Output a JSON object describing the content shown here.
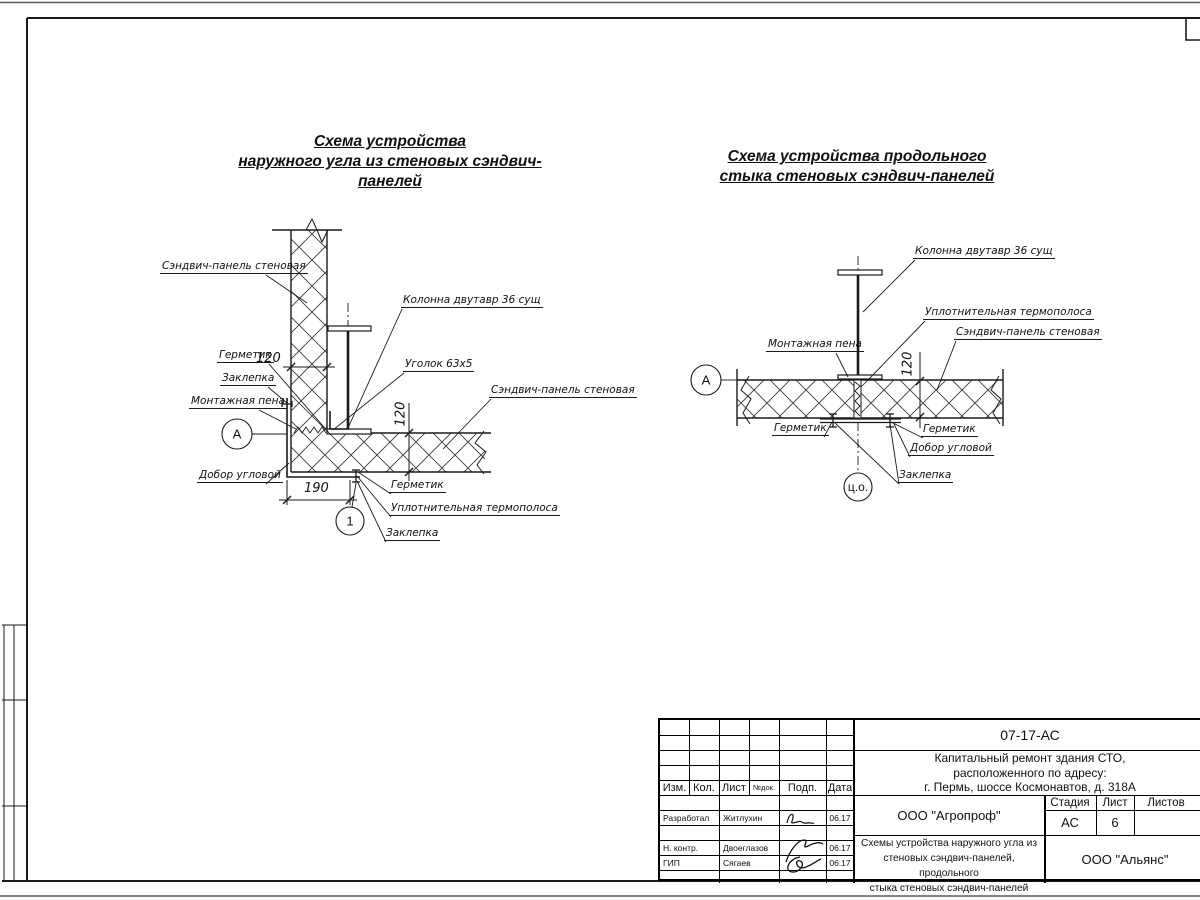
{
  "titles": {
    "left": [
      "Схема устройства",
      "наружного угла из стеновых сэндвич-панелей"
    ],
    "right": [
      "Схема устройства продольного",
      "стыка стеновых сэндвич-панелей"
    ]
  },
  "left_detail": {
    "labels": {
      "wall_panel": "Сэндвич-панель стеновая",
      "column": "Колонна двутавр 36 сущ",
      "angle": "Уголок 63х5",
      "wall_panel_2": "Сэндвич-панель стеновая",
      "sealant_top": "Герметик",
      "rivet_top": "Заклепка",
      "foam": "Монтажная пена",
      "corner_trim": "Добор угловой",
      "sealant_bottom": "Герметик",
      "thermal_strip": "Уплотнительная термополоса",
      "rivet_bottom": "Заклепка"
    },
    "dims": {
      "wall_thickness": "120",
      "panel_thickness": "120",
      "corner_width": "190"
    },
    "markers": {
      "axis": "А",
      "detail": "1"
    }
  },
  "right_detail": {
    "labels": {
      "column": "Колонна двутавр 36 сущ",
      "thermal_strip": "Уплотнительная термополоса",
      "wall_panel": "Сэндвич-панель стеновая",
      "foam": "Монтажная пена",
      "sealant_left": "Герметик",
      "sealant_right": "Герметик",
      "corner_trim": "Добор угловой",
      "rivet": "Заклепка"
    },
    "dims": {
      "panel_thickness": "120"
    },
    "markers": {
      "axis": "А",
      "center": "ц.о."
    }
  },
  "title_block": {
    "doc_number": "07-17-АС",
    "project_lines": [
      "Капитальный ремонт здания СТО,",
      "расположенного по адресу:",
      "г. Пермь, шоссе Космонавтов, д. 318А"
    ],
    "table_headers": [
      "Изм.",
      "Кол.",
      "Лист",
      "№док.",
      "Подп.",
      "Дата"
    ],
    "rows": [
      {
        "role": "Разработал",
        "name": "Житлухин",
        "date": "06.17"
      },
      {
        "role": "Н. контр.",
        "name": "Двоеглазов",
        "date": "06.17"
      },
      {
        "role": "ГИП",
        "name": "Сягаев",
        "date": "06.17"
      }
    ],
    "org": "ООО \"Агропроф\"",
    "stage_label": "Стадия",
    "sheet_label": "Лист",
    "sheets_label": "Листов",
    "stage": "АС",
    "sheet_number": "6",
    "theme_lines": [
      "Схемы устройства наружного угла из",
      "стеновых сэндвич-панелей, продольного",
      "стыка стеновых сэндвич-панелей"
    ],
    "contractor": "ООО \"Альянс\""
  }
}
